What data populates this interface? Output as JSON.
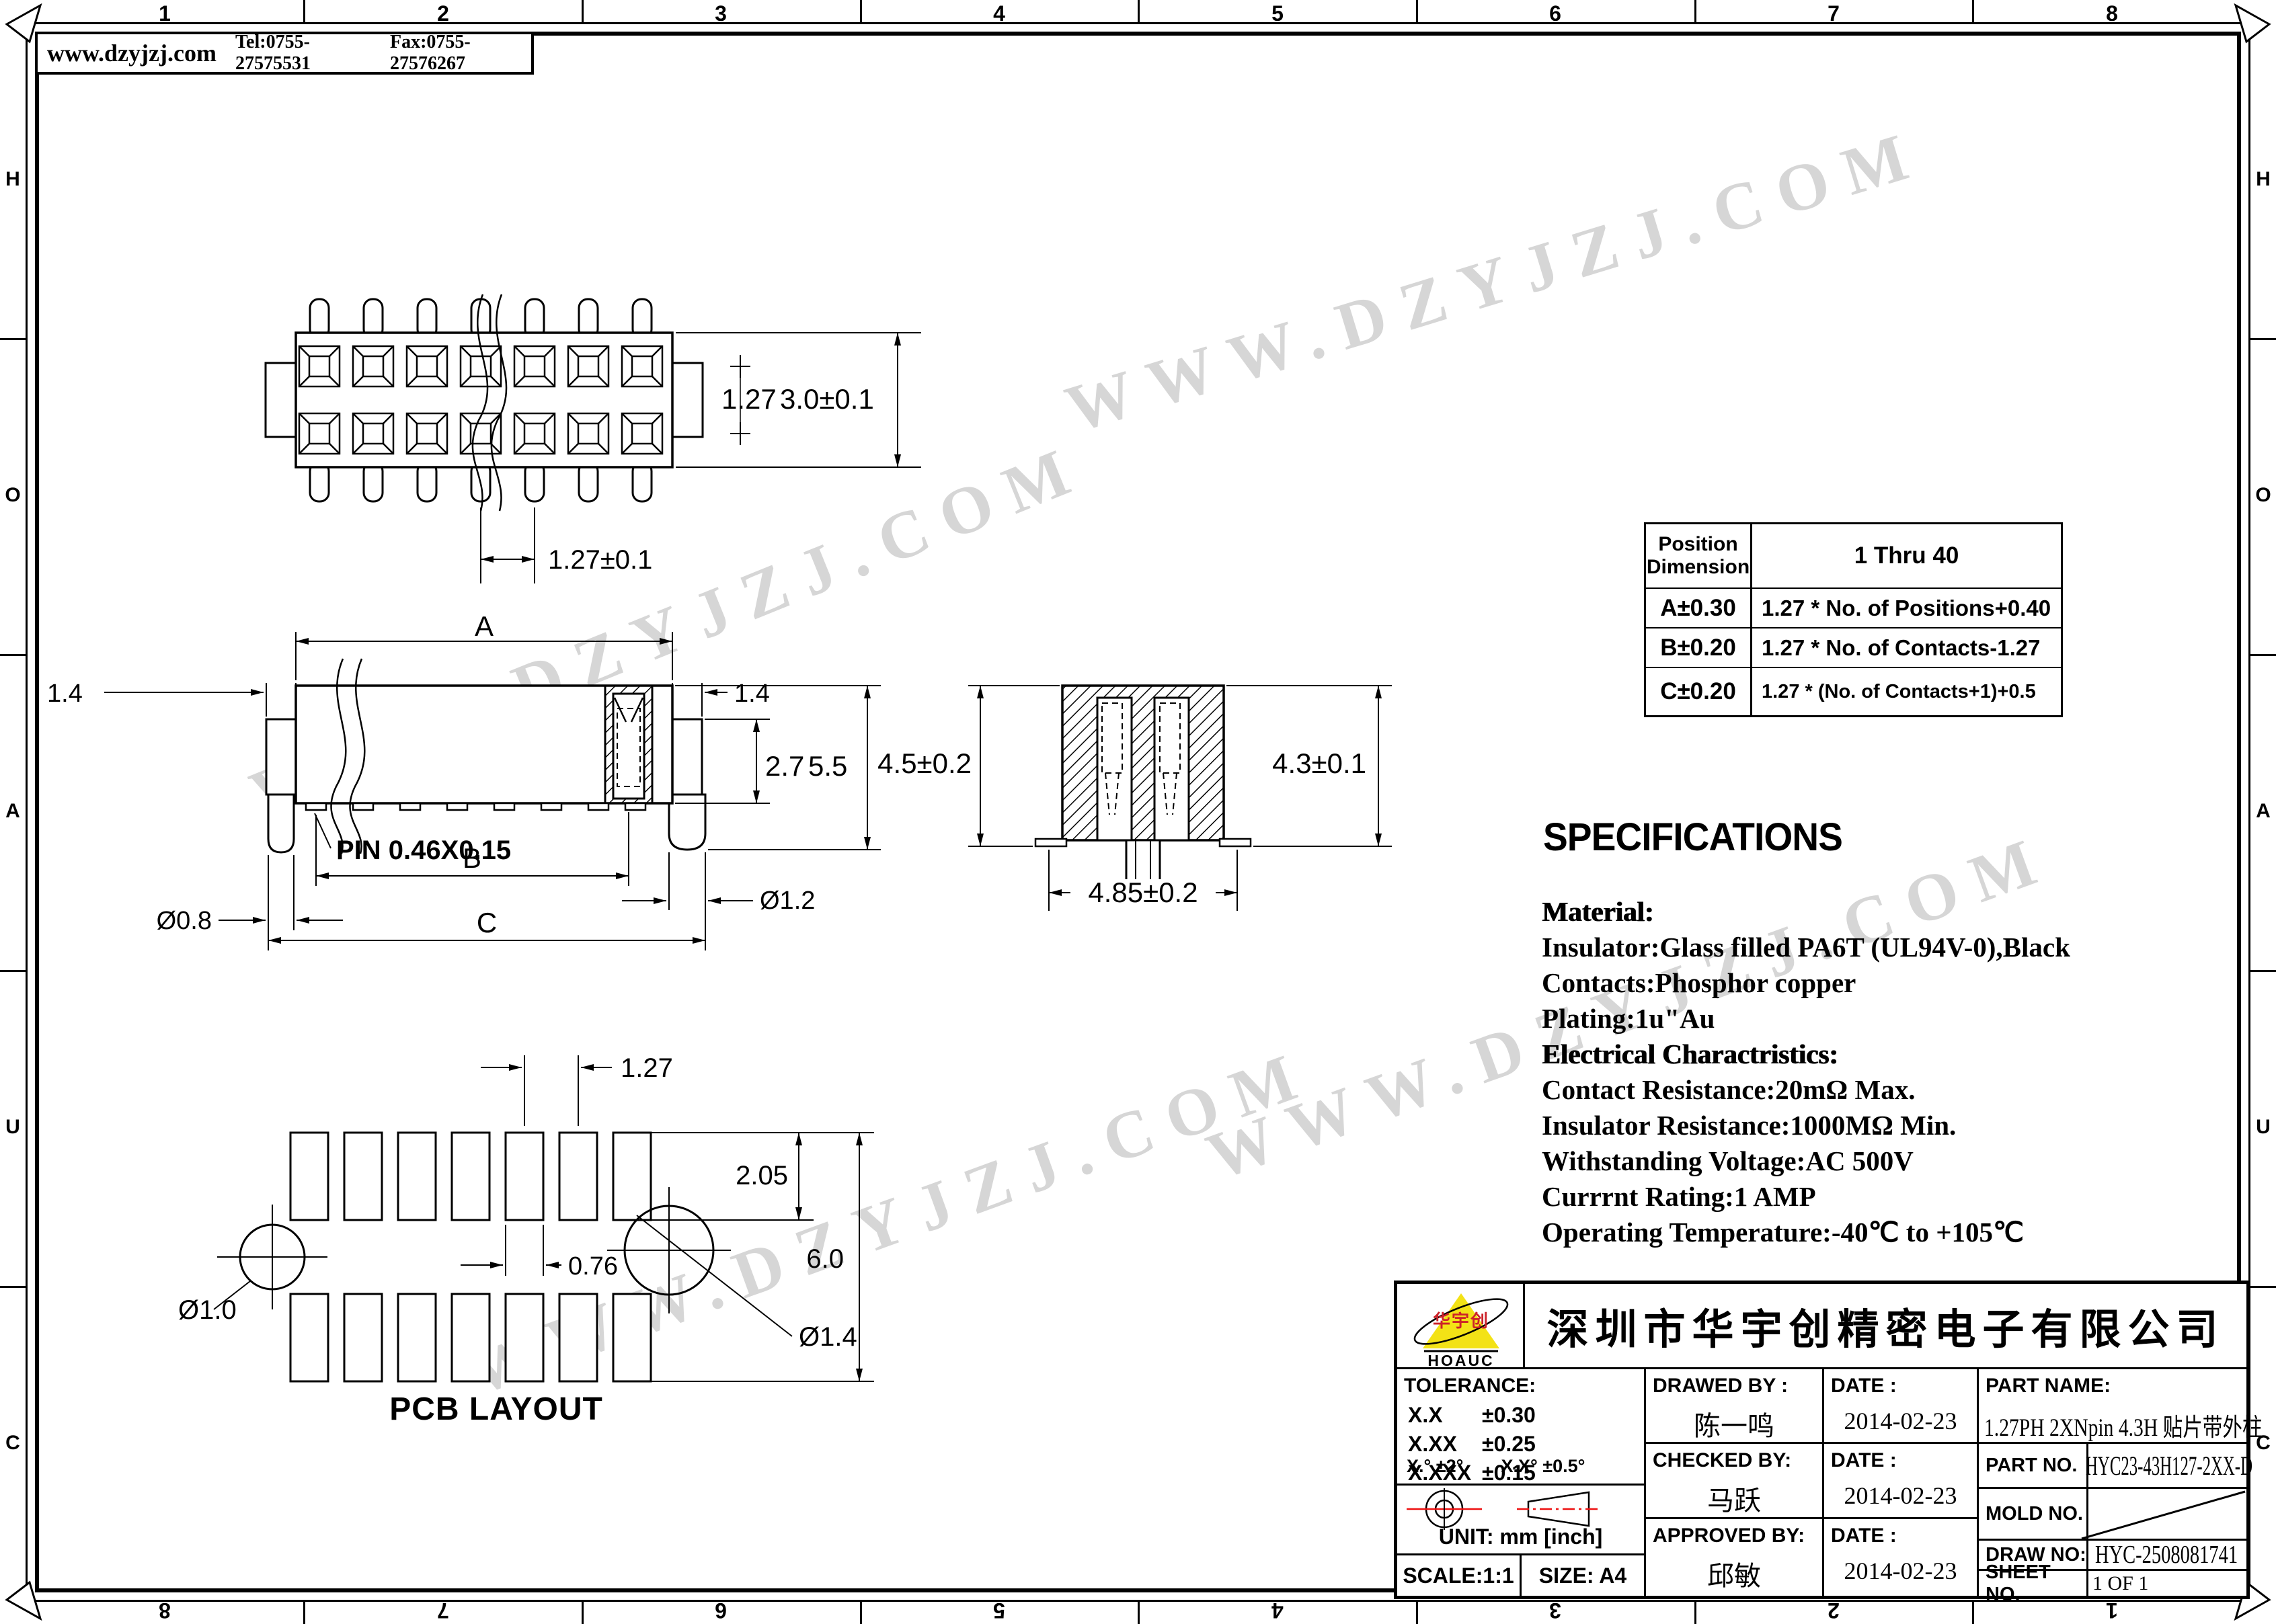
{
  "header": {
    "website": "www.dzyjzj.com",
    "tel": "Tel:0755-27575531",
    "fax": "Fax:0755-27576267"
  },
  "border": {
    "cols": [
      "1",
      "2",
      "3",
      "4",
      "5",
      "6",
      "7",
      "8"
    ],
    "cols_bottom": [
      "8",
      "7",
      "6",
      "5",
      "4",
      "3",
      "2",
      "1"
    ],
    "rows": [
      "H",
      "O",
      "A",
      "U",
      "C"
    ]
  },
  "watermark": {
    "text": "WWW.DZYJZJ.COM"
  },
  "top_view": {
    "row_pitch": "1.27",
    "height": "3.0±0.1",
    "pitch": "1.27±0.1"
  },
  "front_view": {
    "dim_a": "A",
    "tab_left": "1.4",
    "tab_right": "1.4",
    "body_h": "2.7",
    "total_h": "5.5",
    "pin": "PIN 0.46X0.15",
    "dim_b": "B",
    "dim_c": "C",
    "lead": "Ø0.8",
    "post": "Ø1.2"
  },
  "side_view": {
    "h_left": "4.5±0.2",
    "h_right": "4.3±0.1",
    "w_bottom": "4.85±0.2"
  },
  "pcb": {
    "pitch": "1.27",
    "pad_h": "2.05",
    "pad_w": "0.76",
    "span": "6.0",
    "hole_small": "Ø1.0",
    "hole_large": "Ø1.4",
    "title": "PCB LAYOUT"
  },
  "table": {
    "h1": "Position",
    "h1b": "Dimension",
    "h2": "1  Thru 40",
    "rows": [
      {
        "d": "A±0.30",
        "f": "1.27 * No. of Positions+0.40"
      },
      {
        "d": "B±0.20",
        "f": "1.27 * No. of Contacts-1.27"
      },
      {
        "d": "C±0.20",
        "f": "1.27 * (No. of Contacts+1)+0.5"
      }
    ]
  },
  "specs": {
    "title": "SPECIFICATIONS",
    "lines": [
      "Material:",
      "Insulator:Glass filled PA6T (UL94V-0),Black",
      "Contacts:Phosphor copper",
      "Plating:1u\"Au",
      "Electrical Charactristics:",
      "Contact Resistance:20mΩ Max.",
      "Insulator Resistance:1000MΩ Min.",
      "Withstanding Voltage:AC 500V",
      "Currrnt Rating:1 AMP",
      "Operating Temperature:-40℃ to +105℃"
    ]
  },
  "title_block": {
    "company": "深圳市华宇创精密电子有限公司",
    "logo_text": "华宇创",
    "logo_brand": "HOAUC",
    "tolerance_label": "TOLERANCE:",
    "tol": [
      {
        "k": "X.X",
        "v": "±0.30"
      },
      {
        "k": "X.XX",
        "v": "±0.25"
      },
      {
        "k": "X.XXX",
        "v": "±0.15"
      }
    ],
    "tol_angle1": "X.° ±2°",
    "tol_angle2": "X.X° ±0.5°",
    "unit": "UNIT: mm [inch]",
    "scale": "SCALE:1:1",
    "size": "SIZE: A4",
    "drawed_label": "DRAWED BY :",
    "drawed": "陈一鸣",
    "checked_label": "CHECKED BY:",
    "checked": "马跃",
    "approved_label": "APPROVED BY:",
    "approved": "邱敏",
    "date_label": "DATE :",
    "date_drawed": "2014-02-23",
    "date_checked": "2014-02-23",
    "date_approved": "2014-02-23",
    "part_name_label": "PART NAME:",
    "part_name": "1.27PH 2XNpin 4.3H 贴片带外柱",
    "part_no_label": "PART NO.",
    "part_no": "HYC23-43H127-2XX-D",
    "mold_no_label": "MOLD NO.",
    "draw_no_label": "DRAW NO:",
    "draw_no": "HYC-2508081741",
    "sheet_no_label": "SHEET NO.",
    "sheet_no": "1 OF 1"
  }
}
